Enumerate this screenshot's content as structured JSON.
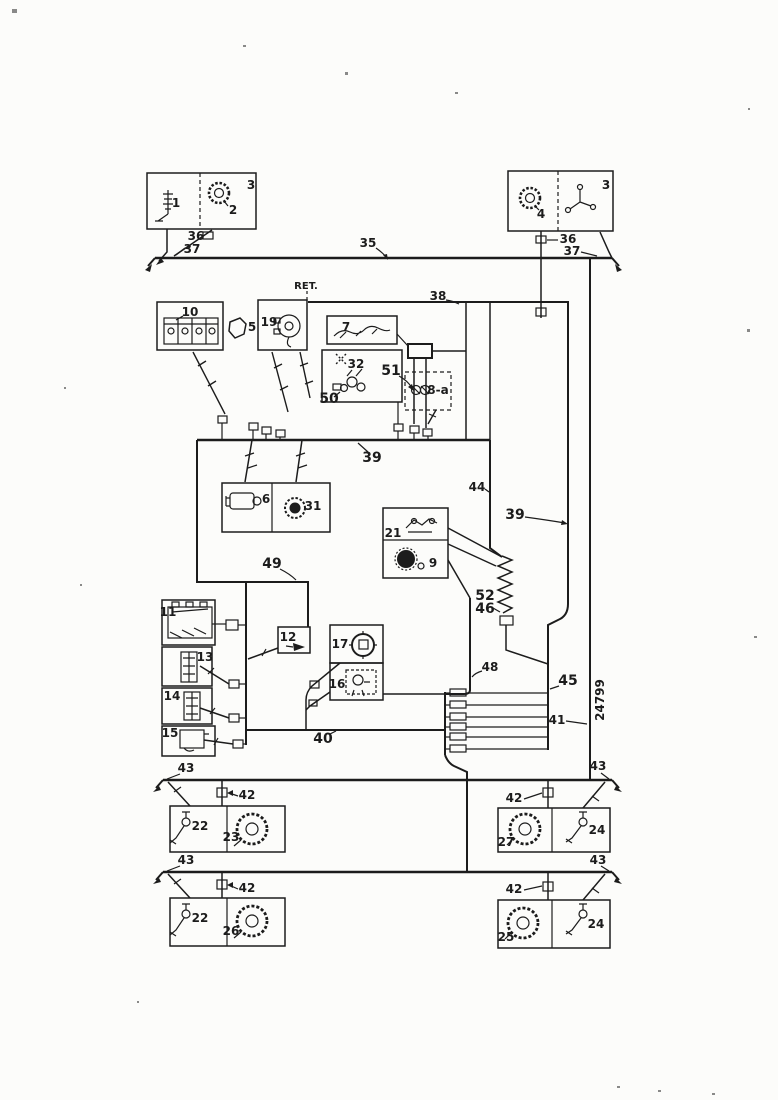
{
  "page": {
    "ink_color": "#1c1c1c",
    "paper_color": "#fcfcfa"
  },
  "diagram": {
    "ret_label": "RET.",
    "drawing_number": "24799",
    "callouts": {
      "n1": "1",
      "n2": "2",
      "n3": "3",
      "n4": "4",
      "n5": "5",
      "n6": "6",
      "n7": "7",
      "n8a": "8-a",
      "n9": "9",
      "n10": "10",
      "n11": "11",
      "n12": "12",
      "n13": "13",
      "n14": "14",
      "n15": "15",
      "n16": "16",
      "n17": "17",
      "n19": "19",
      "n21": "21",
      "n22": "22",
      "n23": "23",
      "n24": "24",
      "n25": "25",
      "n26": "26",
      "n27": "27",
      "n31": "31",
      "n32": "32",
      "n35": "35",
      "n36": "36",
      "n37": "37",
      "n38": "38",
      "n39": "39",
      "n40": "40",
      "n41": "41",
      "n42": "42",
      "n43": "43",
      "n44": "44",
      "n45": "45",
      "n46": "46",
      "n48": "48",
      "n49": "49",
      "n50": "50",
      "n51": "51",
      "n52": "52"
    }
  }
}
